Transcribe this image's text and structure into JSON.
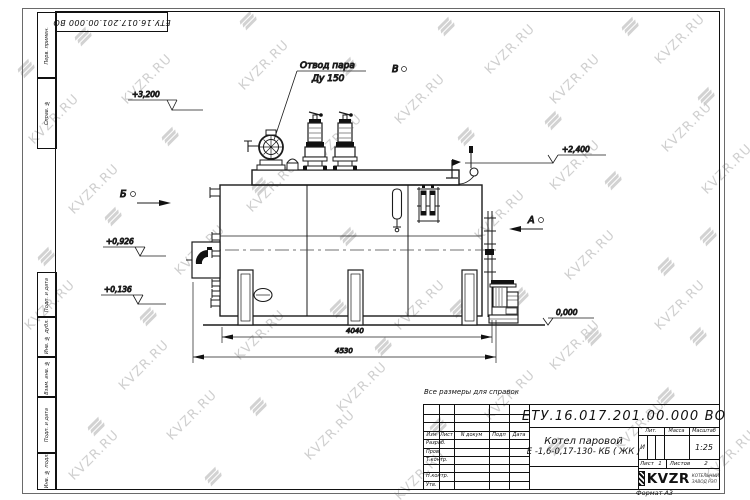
{
  "watermark": {
    "text": "KVZR.RU"
  },
  "frame": {
    "doc_number_top": "ЕТУ.16.017.201.00.000  ВО",
    "left_labels": [
      "Перв. примен.",
      "Справ. №",
      "Подп. и дата",
      "Инв. № дубл.",
      "Взам. инв. №",
      "Подп. и дата",
      "Инв. № подл."
    ]
  },
  "drawing": {
    "callout": {
      "line1": "Отвод пара",
      "line2": "Ду 150"
    },
    "levels": {
      "l1": "+3,200",
      "l2": "+2,400",
      "l3": "+0,926",
      "l4": "+0,136",
      "l5": "0,000"
    },
    "dims": {
      "d1": "4040",
      "d2": "4530"
    },
    "views": {
      "b": "Б",
      "a": "А",
      "v": "В"
    }
  },
  "note": "Все размеры для справок",
  "title_block": {
    "doc_number": "ЕТУ.16.017.201.00.000  ВО",
    "name_line1": "Котел паровой",
    "name_line2": "Е -1,6-0,17-130- КБ ( ЖК )",
    "rev_header": {
      "izm": "Изм",
      "list": "Лист",
      "doc": "N докум",
      "sign": "Подп",
      "date": "Дата"
    },
    "roles": [
      "Разраб.",
      "Пров.",
      "Т.контр.",
      "Н.контр.",
      "Утв."
    ],
    "lit_label": "Лит.",
    "massa_label": "Масса",
    "scale_label": "Масштаб",
    "lit_value": "И",
    "scale_value": "1:25",
    "sheet_label": "Лист",
    "sheet_value": "1",
    "sheets_label": "Листов",
    "sheets_value": "2",
    "logo": {
      "text": "KVZR",
      "sub1": "КОТЕЛЬНЫЙ",
      "sub2": "ЗАВОД РЭП"
    },
    "format": "Формат А3"
  }
}
